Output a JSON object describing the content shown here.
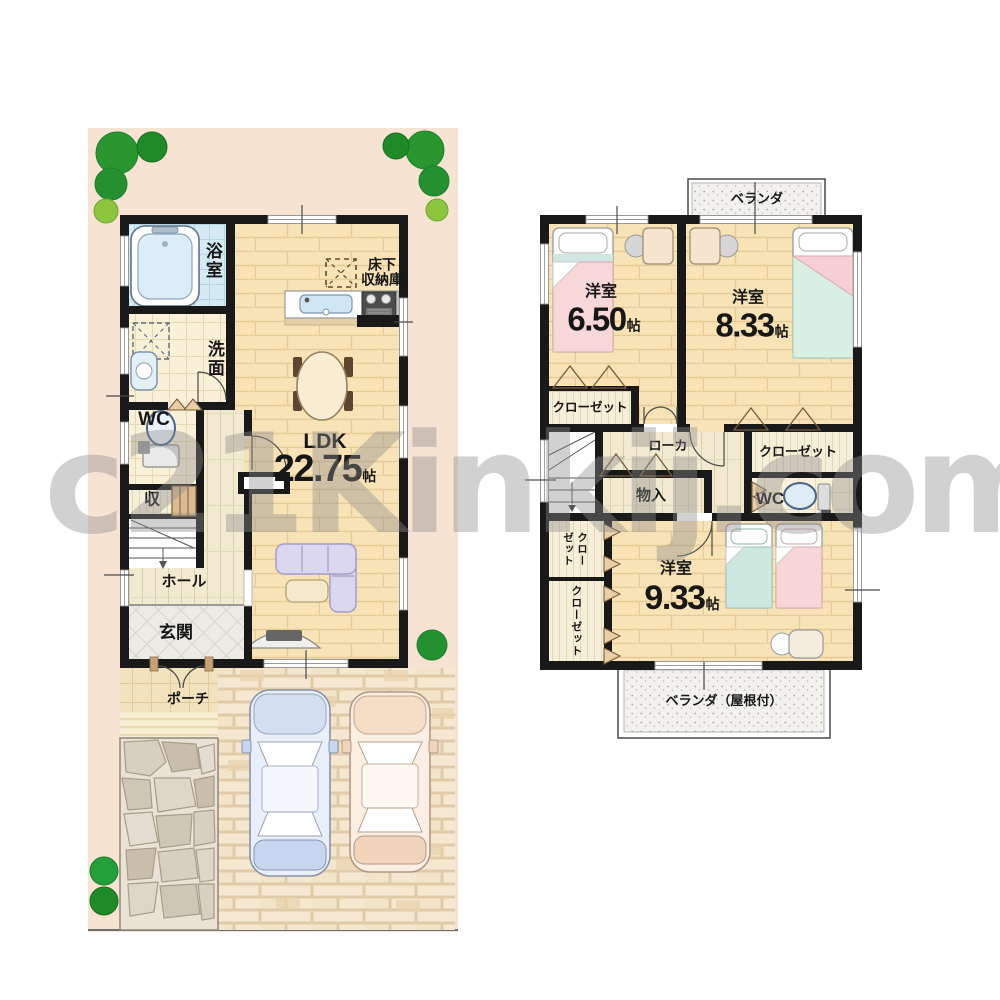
{
  "watermark": "c21Kinkij.com",
  "palette": {
    "site_background": "#f7e3d2",
    "wall": "#191919",
    "watermark_gray": "#8e8e8e"
  },
  "floor1": {
    "bath": "浴室",
    "wash": "洗面",
    "wc": "WC",
    "storage": "収",
    "hall": "ホール",
    "entry": "玄関",
    "porch": "ポーチ",
    "underfloor_line1": "床下",
    "underfloor_line2": "収納庫",
    "ldk": {
      "name": "LDK",
      "size": "22.75",
      "unit": "帖"
    }
  },
  "floor2": {
    "veranda": "ベランダ",
    "veranda_roofed": "ベランダ（屋根付）",
    "room_650": {
      "name": "洋室",
      "size": "6.50",
      "unit": "帖"
    },
    "room_833": {
      "name": "洋室",
      "size": "8.33",
      "unit": "帖"
    },
    "room_933": {
      "name": "洋室",
      "size": "9.33",
      "unit": "帖"
    },
    "closet_room650": "クローゼット",
    "closet_room833": "クローゼット",
    "closet_room933_upper": "クローゼット",
    "closet_room933_lower": "クローゼット",
    "corridor": "ローカ",
    "storage": "物入",
    "wc": "WC"
  }
}
